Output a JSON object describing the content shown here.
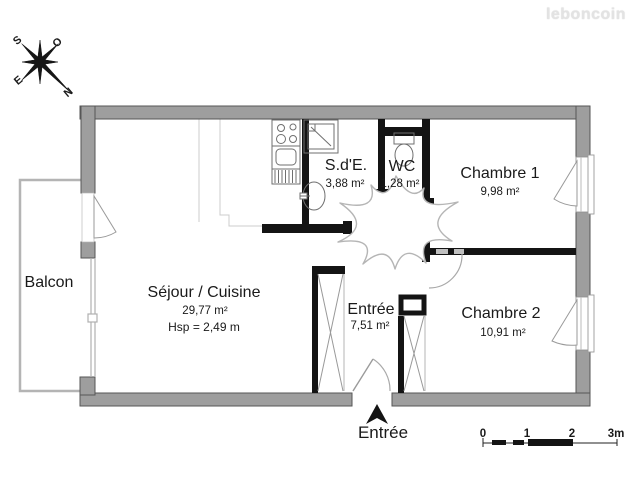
{
  "brand": {
    "watermark": "leboncoin"
  },
  "compass": {
    "south": "S",
    "west_o": "O",
    "east": "E",
    "north": "N"
  },
  "rooms": {
    "balcon": {
      "name": "Balcon"
    },
    "sejour": {
      "name": "Séjour / Cuisine",
      "area": "29,77 m²",
      "ceiling": "Hsp = 2,49 m"
    },
    "sde": {
      "name": "S.d'E.",
      "area": "3,88 m²"
    },
    "wc": {
      "name": "WC",
      "area": "1,28 m²"
    },
    "chambre1": {
      "name": "Chambre 1",
      "area": "9,98 m²"
    },
    "chambre2": {
      "name": "Chambre 2",
      "area": "10,91 m²"
    },
    "entree": {
      "name": "Entrée",
      "area": "7,51 m²"
    }
  },
  "entrance": {
    "label": "Entrée"
  },
  "scalebar": {
    "tick0": "0",
    "tick1": "1",
    "tick2": "2",
    "tick3": "3m"
  }
}
